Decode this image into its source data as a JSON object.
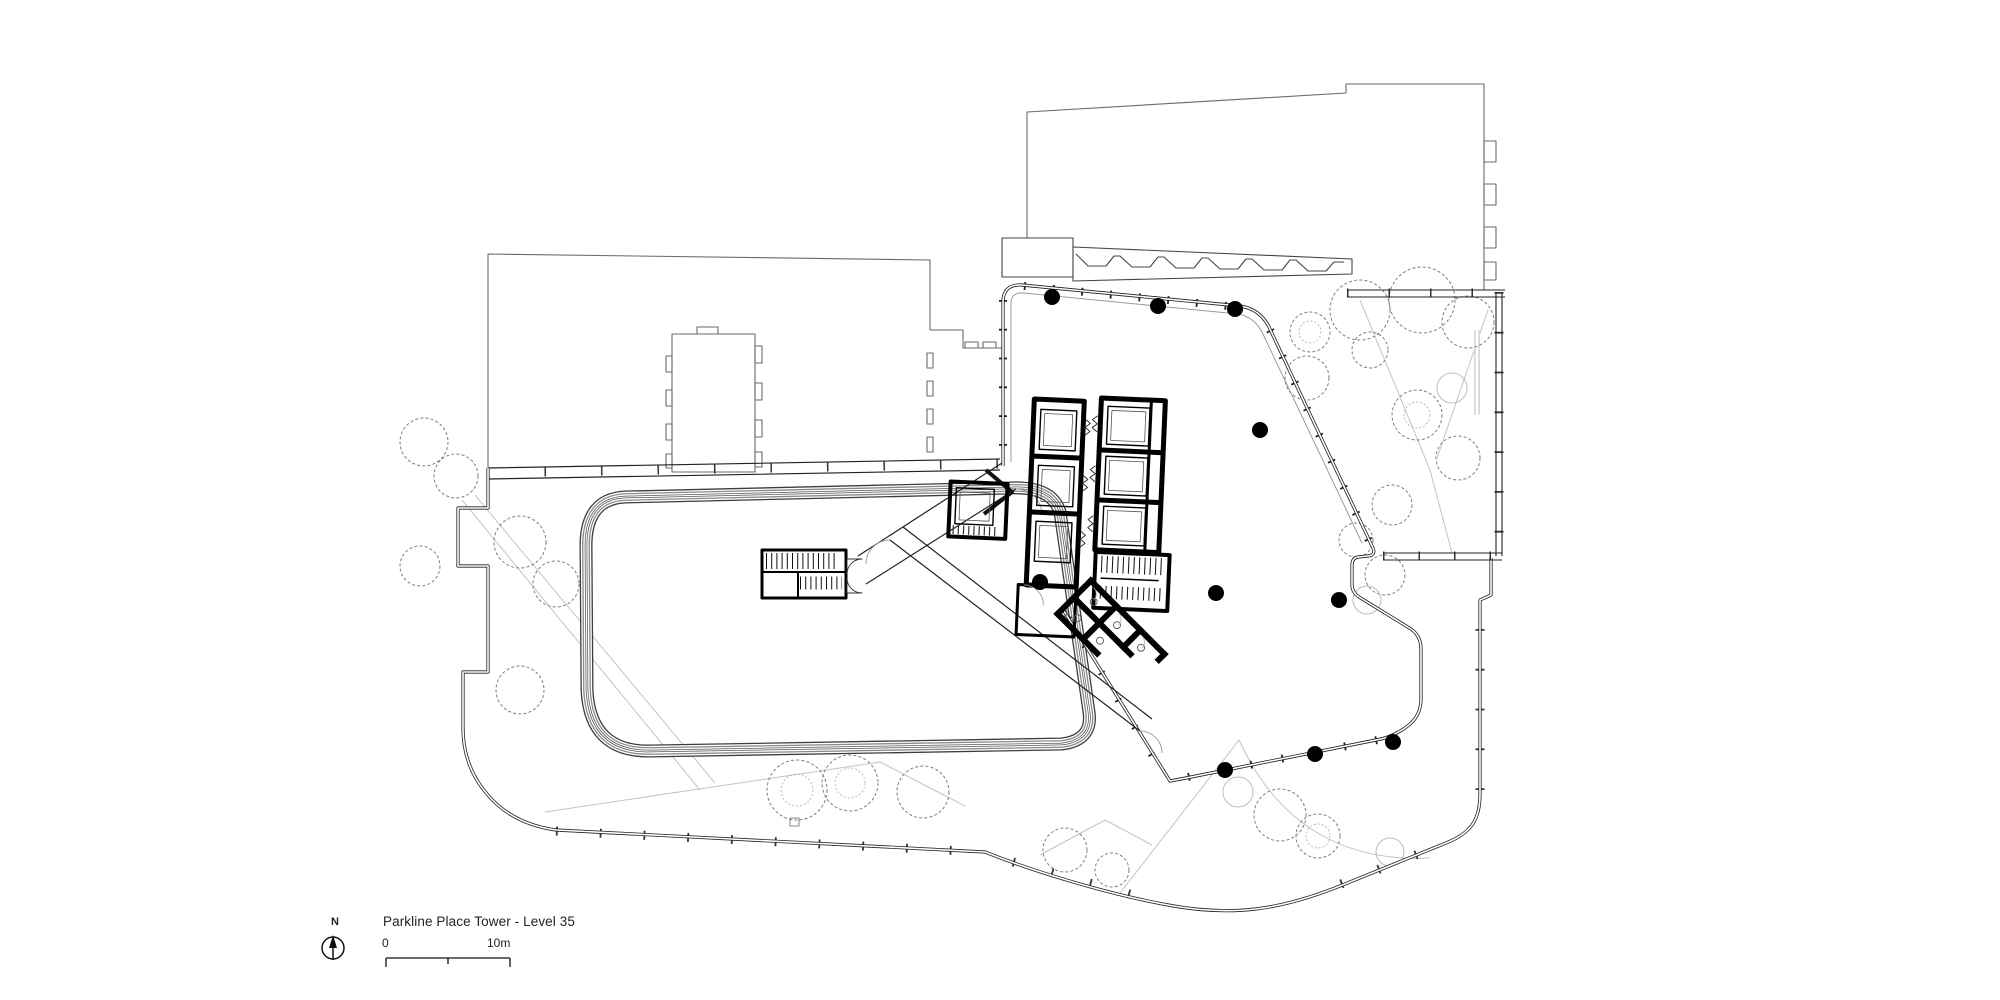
{
  "title_block": {
    "project_title": "Parkline Place Tower - Level 35",
    "north_label": "N",
    "scale": {
      "zero_label": "0",
      "max_label": "10m"
    }
  },
  "colors": {
    "background": "#ffffff",
    "line_primary": "#1c1c1c",
    "line_neighbor": "#666666",
    "line_light": "#bdbdbd",
    "core_fill": "#000000"
  }
}
